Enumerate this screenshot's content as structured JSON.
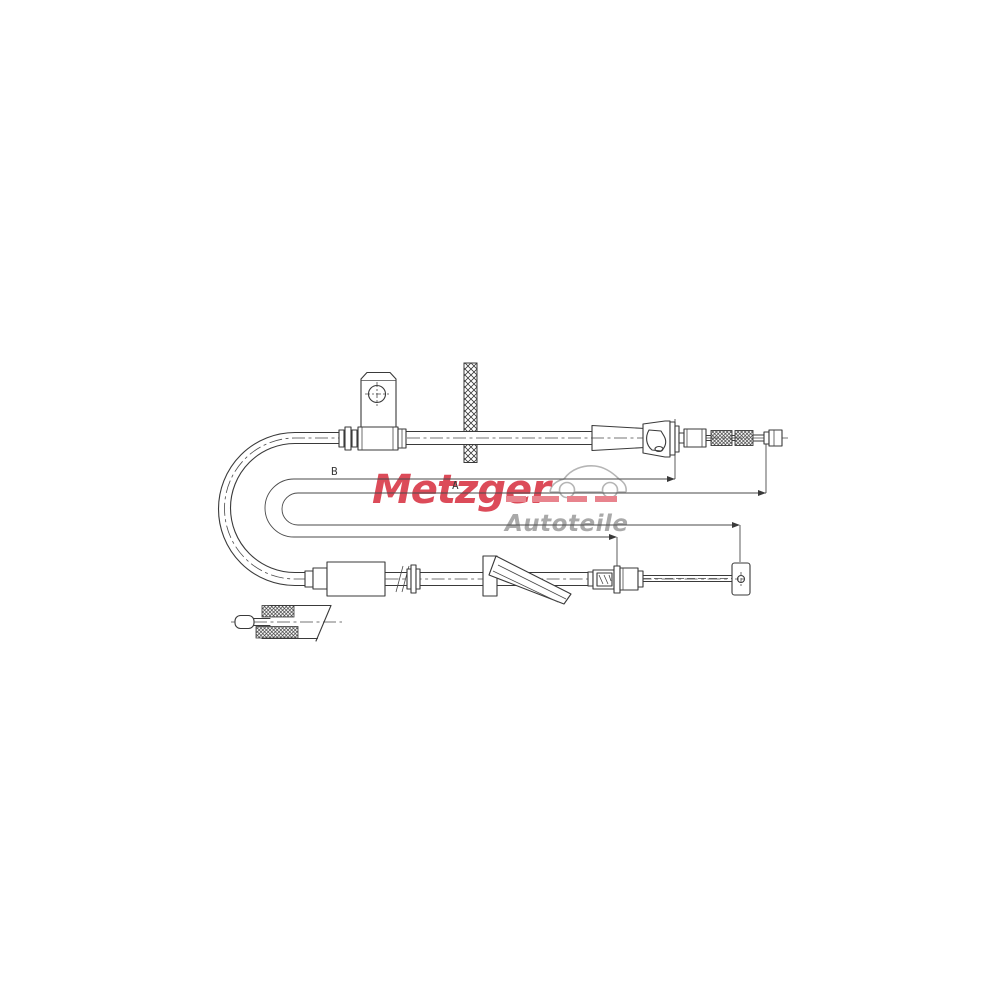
{
  "page": {
    "background_color": "#ffffff"
  },
  "logo": {
    "brand": "Metzger",
    "subtitle": "Autoteile",
    "brand_color": "#dc4b59",
    "dash_color": "#e8838d",
    "subtitle_color": "#a9a9a9",
    "car_color": "#b5b5b5"
  },
  "diagram": {
    "line_color": "#3a3a3a",
    "dim_labels": {
      "b": "B",
      "a": "A"
    }
  }
}
